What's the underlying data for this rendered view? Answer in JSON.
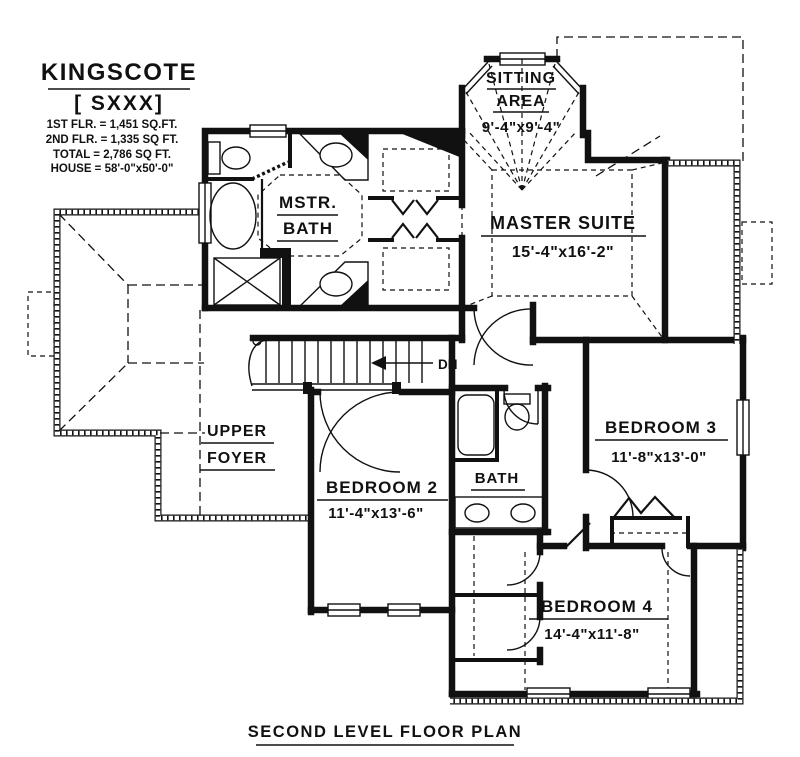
{
  "title_block": {
    "name": "KINGSCOTE",
    "model": "[ SXXX]",
    "stats": [
      "1ST FLR. = 1,451 SQ.FT.",
      "2ND FLR. = 1,335 SQ FT.",
      "TOTAL = 2,786 SQ FT.",
      "HOUSE = 58'-0\"x50'-0\""
    ]
  },
  "rooms": {
    "sitting_area": {
      "name_line1": "SITTING",
      "name_line2": "AREA",
      "dims": "9'-4\"x9'-4\""
    },
    "master_suite": {
      "name": "MASTER SUITE",
      "dims": "15'-4\"x16'-2\""
    },
    "master_bath": {
      "name_line1": "MSTR.",
      "name_line2": "BATH"
    },
    "upper_foyer": {
      "name_line1": "UPPER",
      "name_line2": "FOYER"
    },
    "bedroom_2": {
      "name": "BEDROOM 2",
      "dims": "11'-4\"x13'-6\""
    },
    "bath": {
      "name": "BATH"
    },
    "bedroom_3": {
      "name": "BEDROOM 3",
      "dims": "11'-8\"x13'-0\""
    },
    "bedroom_4": {
      "name": "BEDROOM 4",
      "dims": "14'-4\"x11'-8\""
    }
  },
  "annotations": {
    "stairs_direction": "DN"
  },
  "caption": "SECOND LEVEL FLOOR PLAN",
  "colors": {
    "ink": "#111111",
    "paper": "#ffffff"
  }
}
